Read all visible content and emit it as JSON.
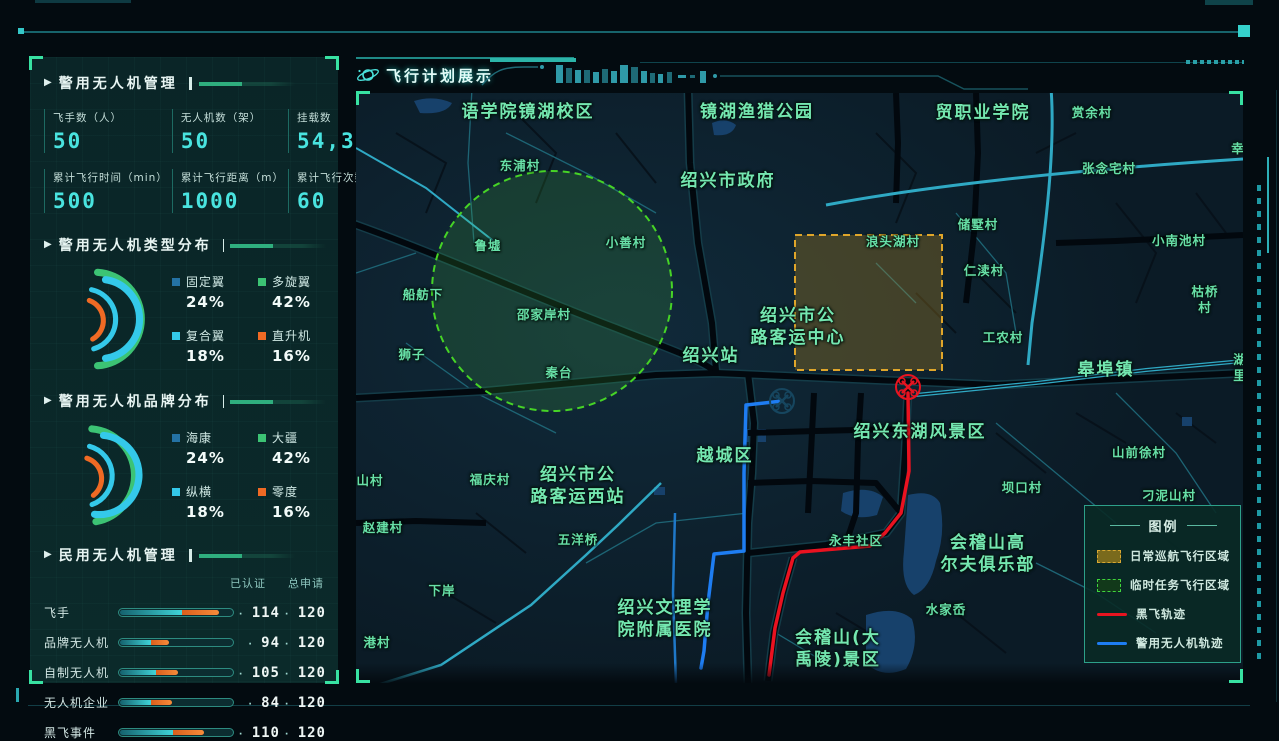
{
  "sidebar": {
    "panels": [
      {
        "title": "警用无人机管理",
        "stats": [
          {
            "label": "飞手数（人）",
            "value": "50"
          },
          {
            "label": "无人机数（架）",
            "value": "50"
          },
          {
            "label": "挂载数",
            "value": "54,324"
          },
          {
            "label": "累计飞行时间（min）",
            "value": "500"
          },
          {
            "label": "累计飞行距离（m）",
            "value": "1000"
          },
          {
            "label": "累计飞行次数",
            "value": "60"
          }
        ]
      },
      {
        "title": "警用无人机类型分布",
        "chart_type": "donut",
        "items": [
          {
            "label": "固定翼",
            "value": 24,
            "pct": "24%",
            "color": "#2472a4"
          },
          {
            "label": "多旋翼",
            "value": 42,
            "pct": "42%",
            "color": "#3cc374"
          },
          {
            "label": "复合翼",
            "value": 18,
            "pct": "18%",
            "color": "#34c9ea"
          },
          {
            "label": "直升机",
            "value": 16,
            "pct": "16%",
            "color": "#f06a24"
          }
        ]
      },
      {
        "title": "警用无人机品牌分布",
        "chart_type": "donut",
        "items": [
          {
            "label": "海康",
            "value": 24,
            "pct": "24%",
            "color": "#2472a4"
          },
          {
            "label": "大疆",
            "value": 42,
            "pct": "42%",
            "color": "#3cc374"
          },
          {
            "label": "纵横",
            "value": 18,
            "pct": "18%",
            "color": "#34c9ea"
          },
          {
            "label": "零度",
            "value": 16,
            "pct": "16%",
            "color": "#f06a24"
          }
        ]
      },
      {
        "title": "民用无人机管理",
        "columns": [
          "已认证",
          "总申请"
        ],
        "rows": [
          {
            "label": "飞手",
            "certified": "114",
            "total": "120",
            "cyan": 55,
            "orange": 33
          },
          {
            "label": "品牌无人机",
            "certified": "94",
            "total": "120",
            "cyan": 28,
            "orange": 16
          },
          {
            "label": "自制无人机",
            "certified": "105",
            "total": "120",
            "cyan": 32,
            "orange": 20
          },
          {
            "label": "无人机企业",
            "certified": "84",
            "total": "120",
            "cyan": 28,
            "orange": 18
          },
          {
            "label": "黑飞事件",
            "certified": "110",
            "total": "120",
            "cyan": 47,
            "orange": 28
          }
        ]
      }
    ]
  },
  "map": {
    "header": {
      "title": "飞行计划展示"
    },
    "zones": {
      "temp_mission_circle": {
        "cx": 196,
        "cy": 198,
        "r": 120,
        "stroke": "#46d426",
        "fill": "rgba(80,200,60,0.16)"
      },
      "daily_cruise_rect": {
        "x": 439,
        "y": 142,
        "w": 147,
        "h": 135,
        "stroke": "#e0a62a",
        "fill": "rgba(190,140,30,0.30)"
      }
    },
    "routes": {
      "black_flight": {
        "color": "#ea1220",
        "points": [
          [
            552,
            300
          ],
          [
            553,
            378
          ],
          [
            545,
            420
          ],
          [
            529,
            440
          ],
          [
            514,
            453
          ],
          [
            444,
            459
          ],
          [
            437,
            465
          ],
          [
            427,
            500
          ],
          [
            419,
            535
          ],
          [
            413,
            582
          ]
        ]
      },
      "police": {
        "color": "#1e7df2",
        "points": [
          [
            426,
            308
          ],
          [
            390,
            312
          ],
          [
            388,
            380
          ],
          [
            388,
            458
          ],
          [
            358,
            461
          ],
          [
            352,
            510
          ],
          [
            348,
            558
          ],
          [
            345,
            575
          ]
        ]
      }
    },
    "drones": [
      {
        "name": "black-flight-drone",
        "x": 552,
        "y": 294,
        "color": "#e81420"
      },
      {
        "name": "police-drone",
        "x": 426,
        "y": 308,
        "color": "#16465f"
      }
    ],
    "labels": [
      {
        "t": "语学院镜湖校区",
        "x": 172,
        "y": 19,
        "s": "lg"
      },
      {
        "t": "镜湖渔猎公园",
        "x": 401,
        "y": 19,
        "s": "lg"
      },
      {
        "t": "贸职业学院",
        "x": 627,
        "y": 20,
        "s": "lg"
      },
      {
        "t": "赏余村",
        "x": 736,
        "y": 20,
        "s": "sm"
      },
      {
        "t": "幸",
        "x": 882,
        "y": 56,
        "s": "sm"
      },
      {
        "t": "东浦村",
        "x": 164,
        "y": 73,
        "s": "sm"
      },
      {
        "t": "绍兴市政府",
        "x": 372,
        "y": 88,
        "s": "lg"
      },
      {
        "t": "张念宅村",
        "x": 753,
        "y": 76,
        "s": "sm"
      },
      {
        "t": "储墅村",
        "x": 622,
        "y": 132,
        "s": "sm"
      },
      {
        "t": "小南池村",
        "x": 823,
        "y": 148,
        "s": "sm"
      },
      {
        "t": "浪头湖村",
        "x": 537,
        "y": 149,
        "s": "sm"
      },
      {
        "t": "仁渎村",
        "x": 628,
        "y": 178,
        "s": "sm"
      },
      {
        "t": "枯桥村",
        "x": 849,
        "y": 207,
        "s": "sm"
      },
      {
        "t": "鲁墟",
        "x": 132,
        "y": 153,
        "s": "sm"
      },
      {
        "t": "小善村",
        "x": 270,
        "y": 150,
        "s": "sm"
      },
      {
        "t": "船舫下",
        "x": 67,
        "y": 202,
        "s": "sm"
      },
      {
        "t": "邵家岸村",
        "x": 188,
        "y": 222,
        "s": "sm"
      },
      {
        "t": "狮子",
        "x": 56,
        "y": 262,
        "s": "sm"
      },
      {
        "t": "秦台",
        "x": 203,
        "y": 280,
        "s": "sm"
      },
      {
        "t": "工农村",
        "x": 647,
        "y": 245,
        "s": "sm"
      },
      {
        "t": "绍兴市公\n路客运中心",
        "x": 442,
        "y": 234,
        "s": "lg"
      },
      {
        "t": "绍兴站",
        "x": 355,
        "y": 263,
        "s": "lg"
      },
      {
        "t": "皋埠镇",
        "x": 750,
        "y": 277,
        "s": "lg"
      },
      {
        "t": "湖里",
        "x": 884,
        "y": 275,
        "s": "sm"
      },
      {
        "t": "绍兴东湖风景区",
        "x": 564,
        "y": 339,
        "s": "lg"
      },
      {
        "t": "山前徐村",
        "x": 783,
        "y": 360,
        "s": "sm"
      },
      {
        "t": "坝口村",
        "x": 666,
        "y": 395,
        "s": "sm"
      },
      {
        "t": "越城区",
        "x": 369,
        "y": 363,
        "s": "lg"
      },
      {
        "t": "刁泥山村",
        "x": 813,
        "y": 403,
        "s": "sm"
      },
      {
        "t": "福庆村",
        "x": 134,
        "y": 387,
        "s": "sm"
      },
      {
        "t": "绍兴市公\n路客运西站",
        "x": 222,
        "y": 393,
        "s": "lg"
      },
      {
        "t": "山村",
        "x": 14,
        "y": 388,
        "s": "sm"
      },
      {
        "t": "赵建村",
        "x": 27,
        "y": 435,
        "s": "sm"
      },
      {
        "t": "五洋桥",
        "x": 222,
        "y": 447,
        "s": "sm"
      },
      {
        "t": "下岸",
        "x": 86,
        "y": 498,
        "s": "sm"
      },
      {
        "t": "港村",
        "x": 21,
        "y": 550,
        "s": "sm"
      },
      {
        "t": "绍兴文理学\n院附属医院",
        "x": 309,
        "y": 526,
        "s": "lg"
      },
      {
        "t": "永丰社区",
        "x": 500,
        "y": 448,
        "s": "sm"
      },
      {
        "t": "会稽山高\n尔夫俱乐部",
        "x": 632,
        "y": 461,
        "s": "lg"
      },
      {
        "t": "水家岙",
        "x": 590,
        "y": 517,
        "s": "sm"
      },
      {
        "t": "会稽山(大\n禹陵)景区",
        "x": 482,
        "y": 556,
        "s": "lg"
      }
    ],
    "legend": {
      "title": "图例",
      "items": [
        {
          "label": "日常巡航飞行区域",
          "type": "area",
          "fill": "#7a6a1c",
          "stroke": "#d8a832"
        },
        {
          "label": "临时任务飞行区域",
          "type": "area",
          "fill": "#12391a",
          "stroke": "#3ed43e"
        },
        {
          "label": "黑飞轨迹",
          "type": "line",
          "color": "#e81420"
        },
        {
          "label": "警用无人机轨迹",
          "type": "line",
          "color": "#1e7df2"
        }
      ]
    }
  }
}
